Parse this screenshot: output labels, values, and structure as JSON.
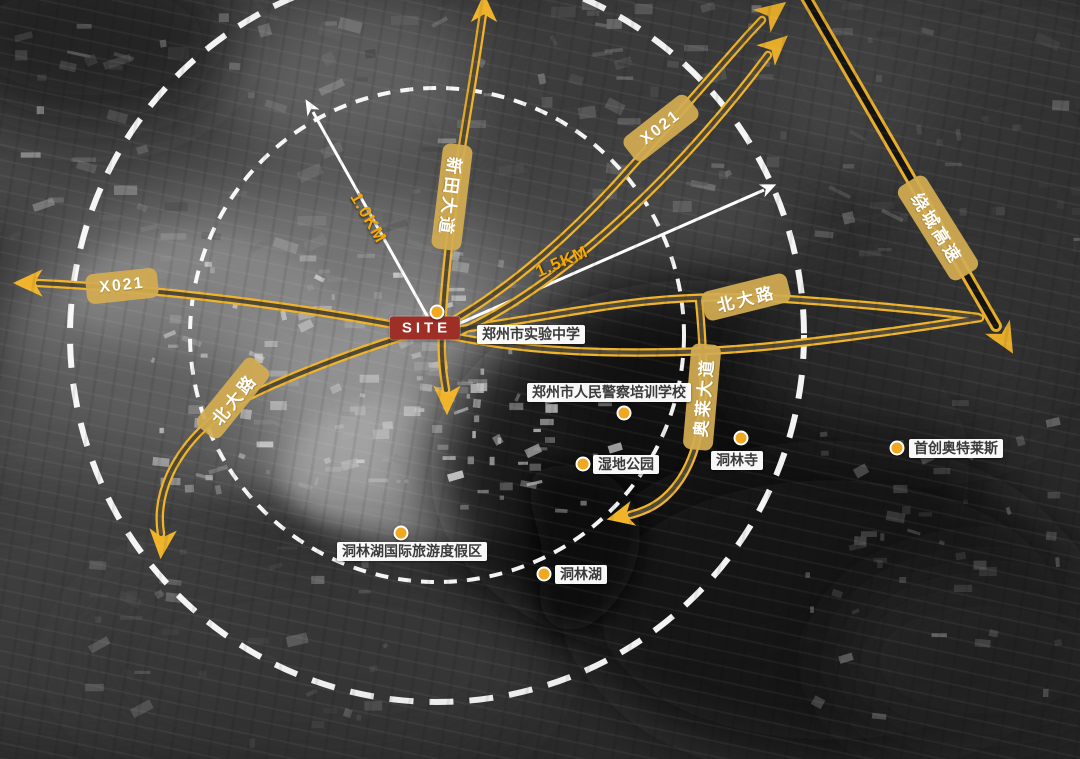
{
  "map": {
    "site_marker": {
      "label": "SITE"
    },
    "distance_markers": [
      {
        "id": "radius-inner",
        "label": "1.0KM"
      },
      {
        "id": "radius-outer",
        "label": "1.5KM"
      }
    ],
    "road_labels": [
      {
        "id": "x021-west",
        "label": "X021"
      },
      {
        "id": "beida-road-west",
        "label": "北大路"
      },
      {
        "id": "xintian-avenue",
        "label": "新田大道"
      },
      {
        "id": "x021-northeast",
        "label": "X021"
      },
      {
        "id": "beida-road-east",
        "label": "北大路"
      },
      {
        "id": "raocheng-expressway",
        "label": "绕城高速"
      },
      {
        "id": "aolai-avenue",
        "label": "奥莱大道"
      }
    ],
    "pois": [
      {
        "id": "zhengzhou-experimental-school",
        "label": "郑州市实验中学"
      },
      {
        "id": "police-training-academy",
        "label": "郑州市人民警察培训学校"
      },
      {
        "id": "wetland-park",
        "label": "湿地公园"
      },
      {
        "id": "donglin-temple",
        "label": "洞林寺"
      },
      {
        "id": "shouchuang-outlets",
        "label": "首创奥特莱斯"
      },
      {
        "id": "donglinhu-resort",
        "label": "洞林湖国际旅游度假区"
      },
      {
        "id": "donglin-lake",
        "label": "洞林湖"
      }
    ],
    "colors": {
      "road": "#F0B42B",
      "road_label_bg": "#D3AC52",
      "poi_dot": "#EFA81F",
      "site_bg": "#9D2F26",
      "distance_text": "#F5A800",
      "radius_circle": "#FFFFFF"
    }
  }
}
